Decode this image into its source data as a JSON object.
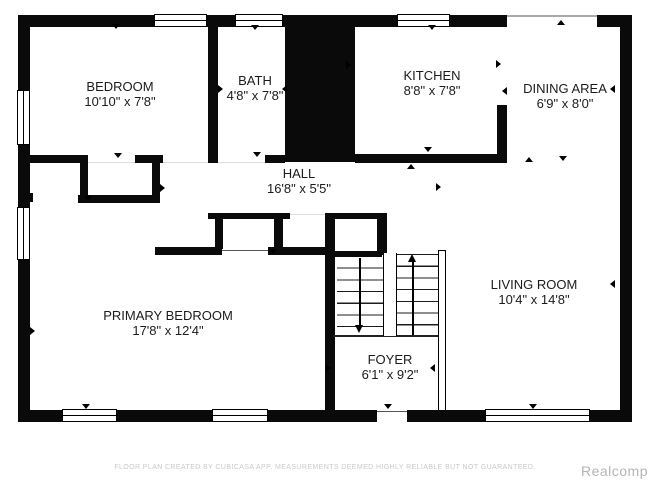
{
  "plan": {
    "rooms": [
      {
        "name": "BEDROOM",
        "dims": "10'10\" x 7'8\""
      },
      {
        "name": "BATH",
        "dims": "4'8\" x 7'8\""
      },
      {
        "name": "KITCHEN",
        "dims": "8'8\" x 7'8\""
      },
      {
        "name": "DINING AREA",
        "dims": "6'9\" x 8'0\""
      },
      {
        "name": "HALL",
        "dims": "16'8\" x 5'5\""
      },
      {
        "name": "PRIMARY BEDROOM",
        "dims": "17'8\" x 12'4\""
      },
      {
        "name": "LIVING ROOM",
        "dims": "10'4\" x 14'8\""
      },
      {
        "name": "FOYER",
        "dims": "6'1\" x 9'2\""
      }
    ]
  },
  "footer": {
    "disclaimer": "FLOOR PLAN CREATED BY CUBICASA APP. MEASUREMENTS DEEMED HIGHLY RELIABLE BUT NOT GUARANTEED."
  },
  "watermark": {
    "text": "Realcomp"
  },
  "colors": {
    "wall": "#0a0a0a",
    "background": "#ffffff",
    "label_text": "#1b1b1b",
    "footer_text": "#c9c9c9",
    "watermark_text": "#b4b4b4"
  }
}
